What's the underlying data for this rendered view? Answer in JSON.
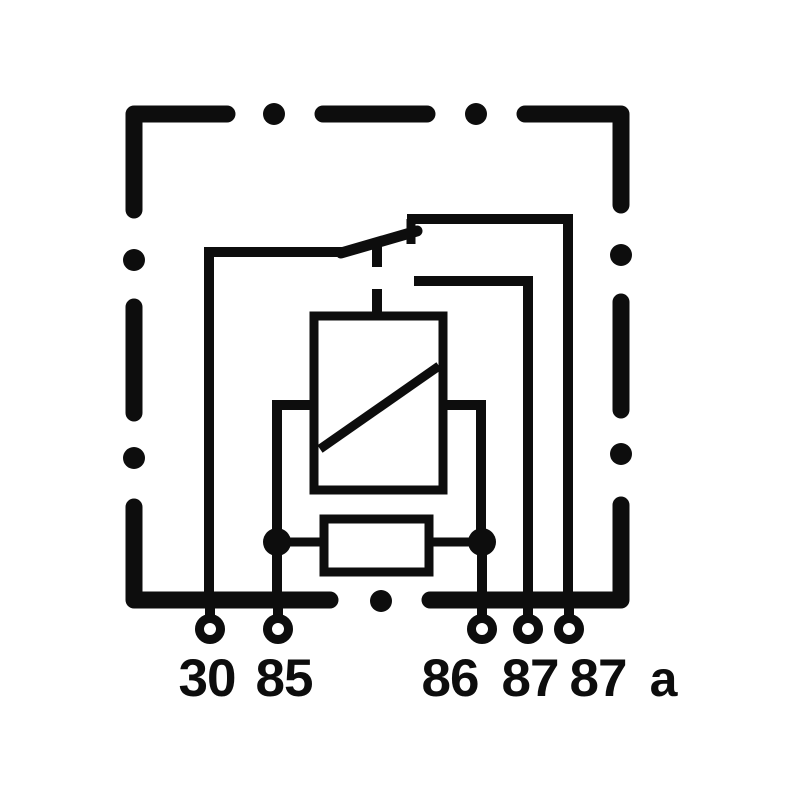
{
  "figure": {
    "kind": "relay-wiring-diagram",
    "description": "Automotive relay schematic with changeover contact inside a dashed enclosure",
    "colors": {
      "ink": "#0d0d0d",
      "background": "#ffffff"
    },
    "components": {
      "enclosure": "dashed-relay-housing-outline",
      "coil": "relay-coil-rect-with-diagonal",
      "resistor": "parallel-resistor-rect",
      "switch": "changeover-contact-armature",
      "linkage": "dashed-mechanical-linkage",
      "junctions": "two-solder-junction-dots",
      "terminals": "five-ring-terminals"
    }
  },
  "terminals": {
    "t30": "30",
    "t85": "85",
    "t86": "86",
    "t87": "87",
    "t87a_num": "87",
    "t87a_suffix": "a"
  }
}
